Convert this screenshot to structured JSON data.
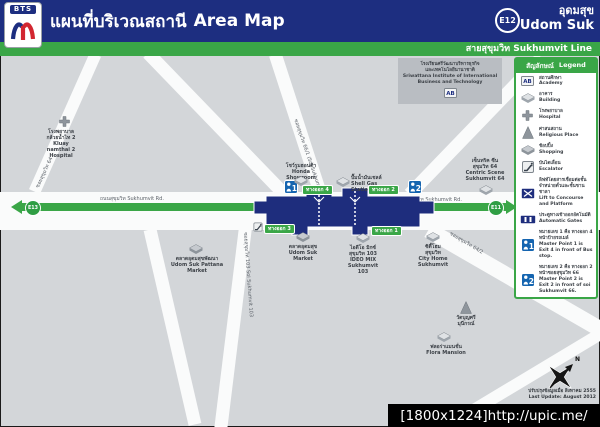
{
  "header": {
    "logo": "BTS",
    "title_th": "แผนที่บริเวณสถานี",
    "title_en": "Area Map",
    "station_code": "E12",
    "station_th": "อุดมสุข",
    "station_en": "Udom Suk",
    "line_bar": "สายสุขุมวิท Sukhumvit Line"
  },
  "legend": {
    "title_th": "สัญลักษณ์",
    "title_en": "Legend",
    "items": [
      {
        "icon": "academy-icon",
        "th": "สถานศึกษา",
        "en": "Academy"
      },
      {
        "icon": "building-icon",
        "th": "อาคาร",
        "en": "Building"
      },
      {
        "icon": "hospital-icon",
        "th": "โรงพยาบาล",
        "en": "Hospital"
      },
      {
        "icon": "religious-icon",
        "th": "ศาสนสถาน",
        "en": "Religious Place"
      },
      {
        "icon": "shopping-icon",
        "th": "ช้อปปิ้ง",
        "en": "Shopping"
      },
      {
        "icon": "escalator-icon",
        "th": "บันไดเลื่อน",
        "en": "Escalator"
      },
      {
        "icon": "lift-icon",
        "th": "ลิฟท์โดยสารเชื่อมต่อชั้นจำหน่ายตั๋วและชั้นชานชาลา",
        "en": "Lift to Concourse and Platform"
      },
      {
        "icon": "gates-icon",
        "th": "ประตูทางเข้าออกอัตโนมัติ",
        "en": "Automatic Gates"
      },
      {
        "icon": "master-point-1-icon",
        "th": "หมายเลข 1 คือ ทางออก 4 หน้าป้ายรถเมล์",
        "en": "Master Point 1 is Exit 4 in front of Bus stop."
      },
      {
        "icon": "master-point-2-icon",
        "th": "หมายเลข 2 คือ ทางออก 2 หน้าซอยสุขุมวิท 66",
        "en": "Master Point 2 is Exit 2 in front of soi Sukhumvit 66."
      }
    ]
  },
  "map": {
    "road_labels": {
      "sukhumvit_west": "ถนนสุขุมวิท Sukhumvit Rd.",
      "sukhumvit_east": "ถนนสุขุมวิท Sukhumvit Rd.",
      "soi_66_1": "ซอยสุขุมวิท 66/1 (Soi Sukhumvit 66/1)",
      "soi_103": "ซอยสุขุมวิท 103 Soi Sukhumvit 103",
      "soi_64": "ซอยสุขุมวิท 64",
      "soi_64_2": "ซอยสุขุมวิท 64/2"
    },
    "line": {
      "left_badge": "E13",
      "right_badge": "E11"
    },
    "exits": {
      "e1": "ทางออก 1",
      "e2": "ทางออก 2",
      "e3": "ทางออก 3",
      "e4": "ทางออก 4"
    },
    "master_points": {
      "mp1": "1",
      "mp2": "2"
    },
    "buildings": {
      "honda": {
        "l1": "โชว์รูมฮอนด้า",
        "l2": "Honda Showroom"
      },
      "shell": {
        "l1": "ปั๊มน้ำมันเชลล์",
        "l2": "Shell Gas Station"
      },
      "school": {
        "l1": "โรงเรียนศรีวัฒนาบริหารธุรกิจ",
        "l2": "และเทคโนโลยีนานาชาติ",
        "l3": "Sriwattana Institute of International",
        "l4": "Business and Technology"
      },
      "hospital": {
        "l1": "โรงพยาบาล",
        "l2": "กล้วยน้ำไท 2",
        "l3": "Kluay",
        "l4": "namthai 2",
        "l5": "Hospital"
      },
      "pattana_market": {
        "l1": "ตลาดอุดมสุขพัฒนา",
        "l2": "Udom Suk Pattana",
        "l3": "Market"
      },
      "udomsuk_market": {
        "l1": "ตลาดอุดมสุข",
        "l2": "Udom Suk",
        "l3": "Market"
      },
      "ideo_mix": {
        "l1": "ไอดีโอ มิกซ์",
        "l2": "สุขุมวิท 103",
        "l3": "IDEO MIX",
        "l4": "Sukhumvit 103"
      },
      "city_home": {
        "l1": "ซิตี้โฮม",
        "l2": "สุขุมวิท",
        "l3": "City Home",
        "l4": "Sukhumvit"
      },
      "centric_scene": {
        "l1": "เซ็นทริค ซีน",
        "l2": "สุขุมวิท 64",
        "l3": "Centric Scene",
        "l4": "Sukhumvit 64"
      },
      "flora_mansion": {
        "l1": "ฟลอร่าแมนชั่น",
        "l2": "Flora Mansion"
      },
      "temple": {
        "l1": "วัดบุญศรี",
        "l2": "มุนีกรณ์"
      }
    }
  },
  "footer": {
    "update_th": "ปรับปรุงข้อมูลเมื่อ สิงหาคม 2555",
    "update_en": "Last Update: August 2012",
    "compass_n": "N"
  },
  "watermark": "[1800x1224]http://upic.me/"
}
